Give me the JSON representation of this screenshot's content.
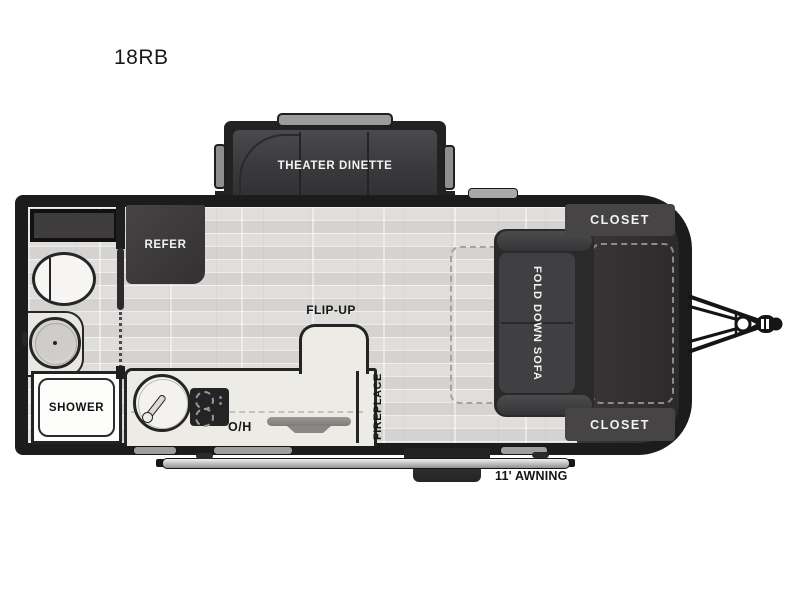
{
  "title": "18RB",
  "plan": {
    "slideout": {
      "label": "THEATER DINETTE"
    },
    "kitchen": {
      "refer_label": "REFER",
      "overhead_label": "O/H",
      "flip_up_label": "FLIP-UP",
      "fireplace_label": "FIREPLACE"
    },
    "bathroom": {
      "shower_label": "SHOWER"
    },
    "bedroom": {
      "sofa_label": "FOLD DOWN SOFA",
      "closet_top_label": "CLOSET",
      "closet_bottom_label": "CLOSET"
    },
    "exterior": {
      "awning_label": "11' AWNING"
    }
  },
  "colors": {
    "wall": "#1c1c1c",
    "floor": "#dfdedc",
    "dark_furniture": "#39383a",
    "front_platform": "#322f30",
    "closet": "#474445",
    "counter": "#edebe6",
    "label_light": "#f3f3f3",
    "label_dark": "#161616",
    "awning_bar": "#bdbdbd"
  }
}
